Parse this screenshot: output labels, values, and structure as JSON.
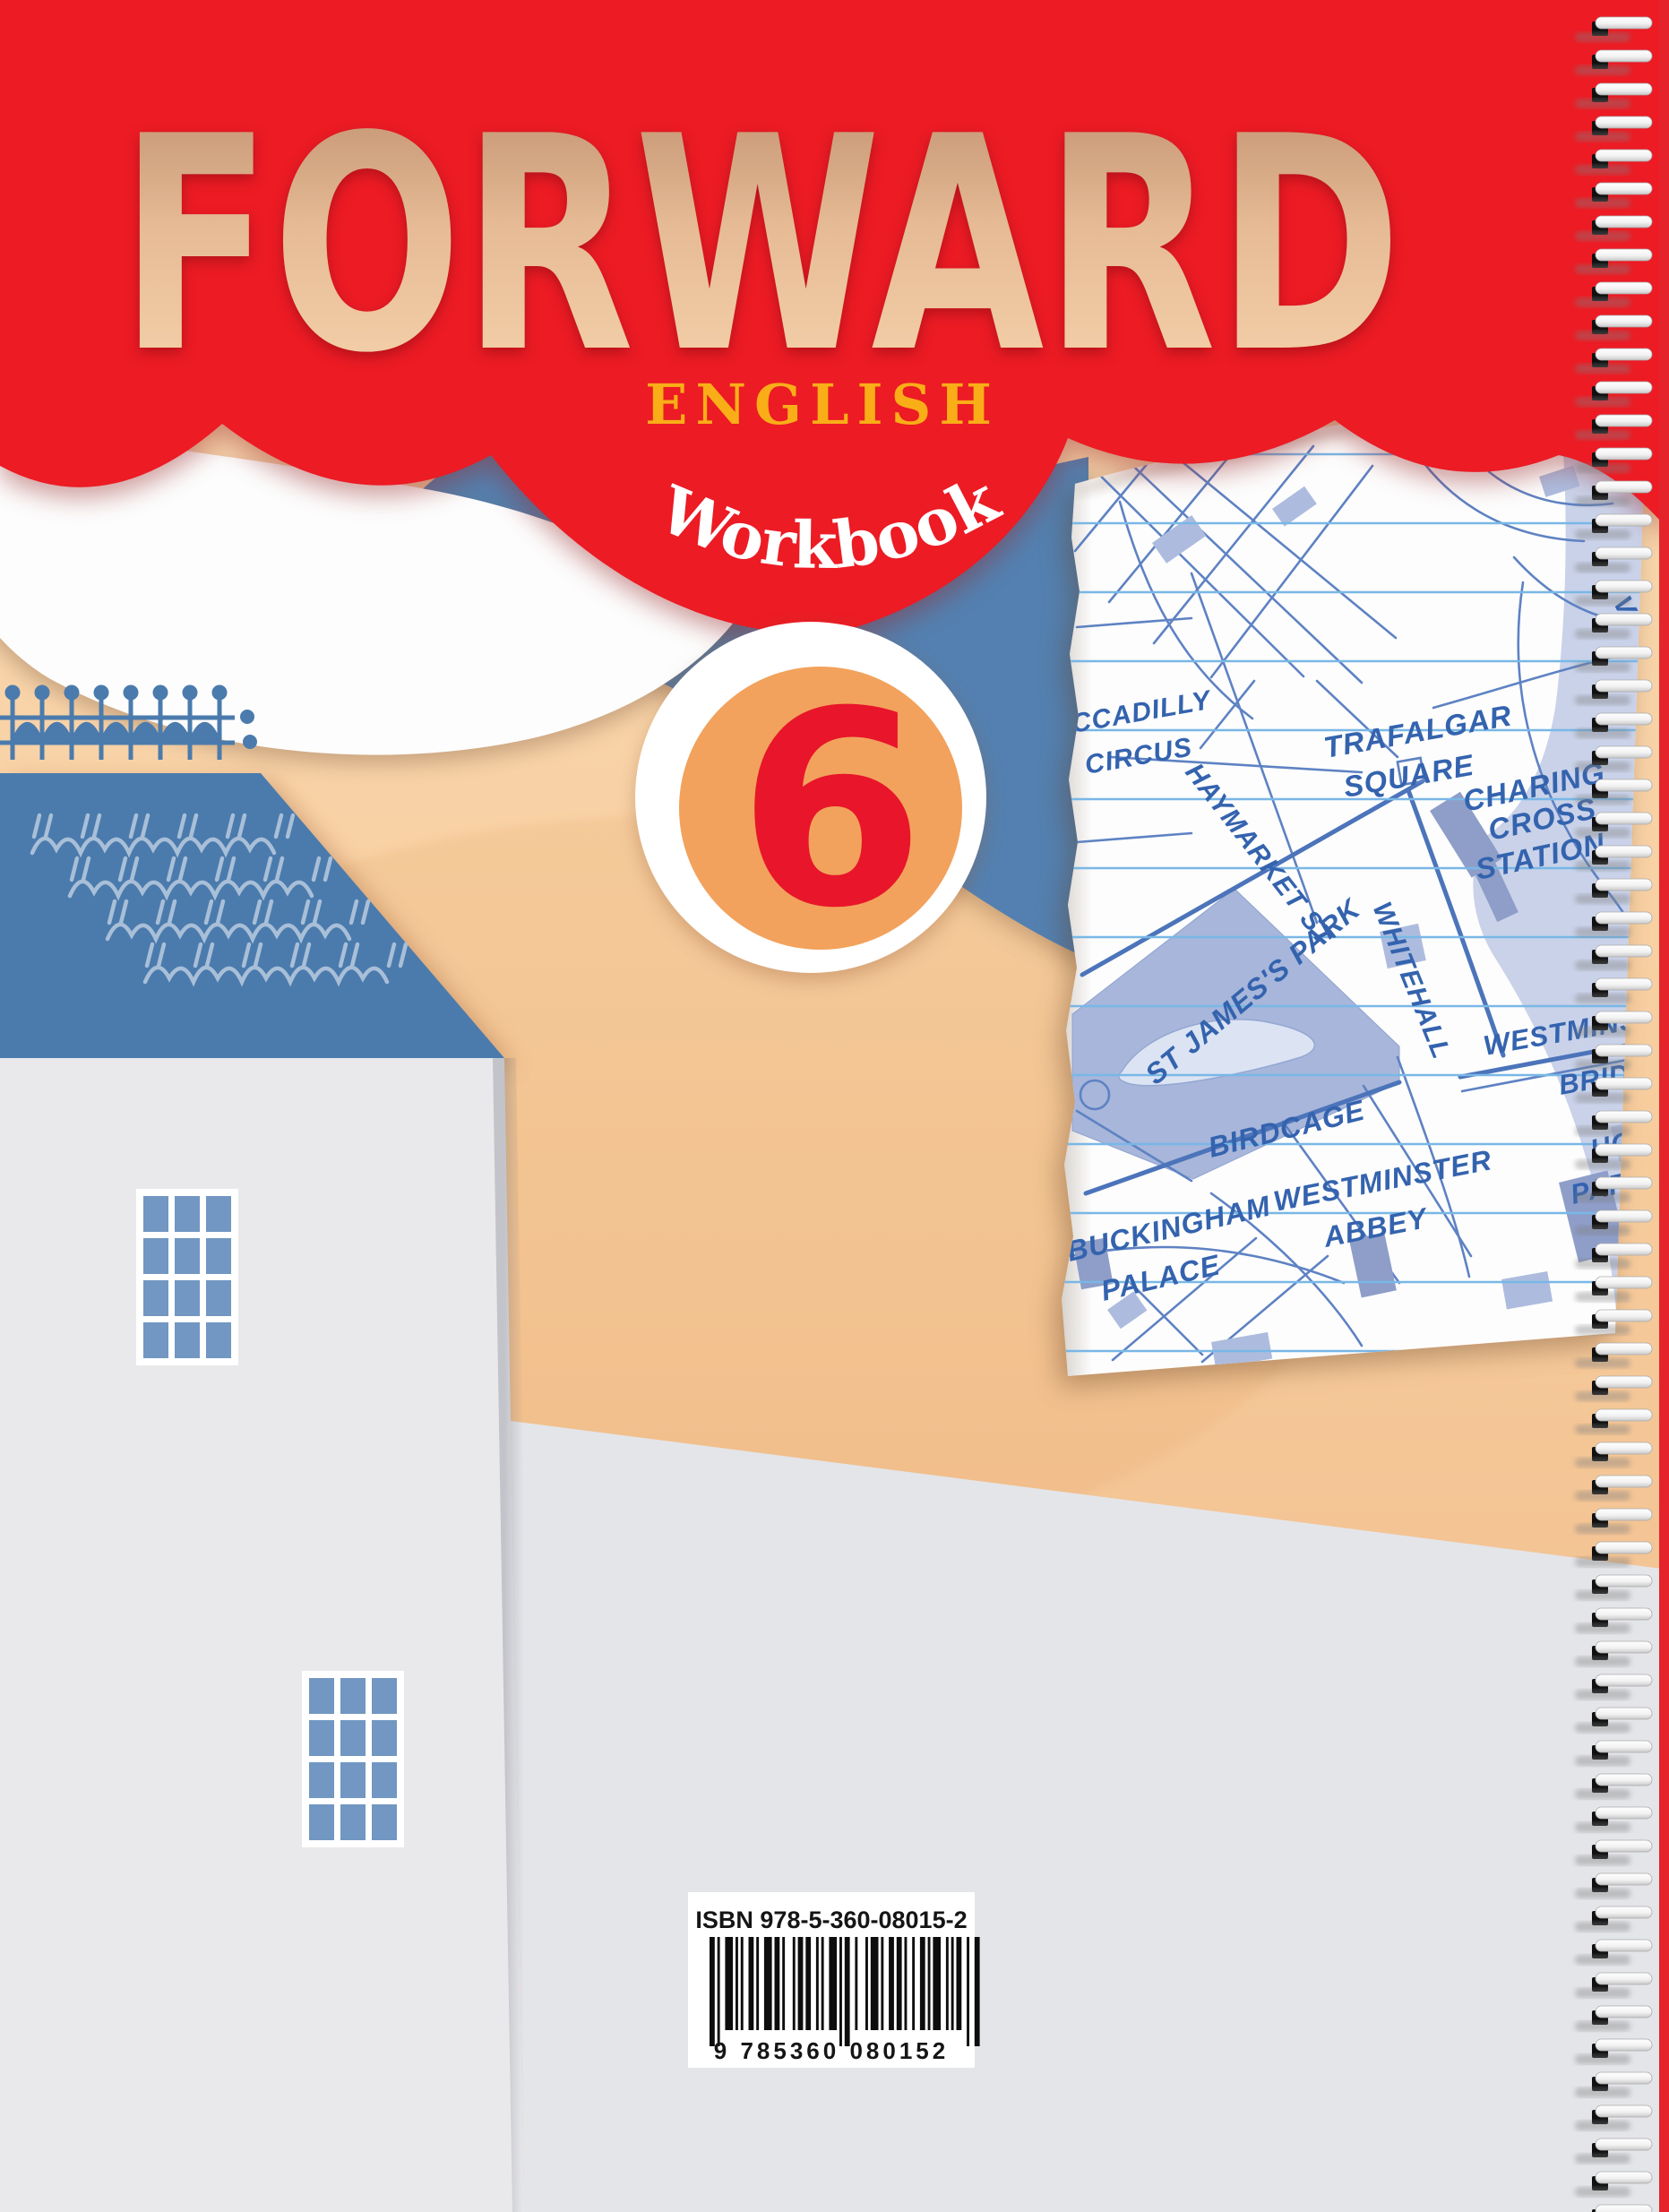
{
  "cover": {
    "title": "FORWARD",
    "subject": "ENGLISH",
    "book_type": "Workbook",
    "level": "6"
  },
  "map_labels": [
    "CCADILLY",
    "CIRCUS",
    "TRAFALGAR",
    "SQUARE",
    "CHARING",
    "CROSS",
    "STATION",
    "HAYMARKET ST",
    "WHITEHALL",
    "ST JAMES'S PARK",
    "BIRDCAGE",
    "WESTMINSTER",
    "ABBEY",
    "BUCKINGHAM",
    "PALACE",
    "WESTMINSTER",
    "BRIDGE",
    "HOUSES",
    "PARLIAM",
    "VI"
  ],
  "barcode": {
    "isbn": "ISBN 978-5-360-08015-2",
    "digits": "9 785360 080152"
  },
  "colors": {
    "red": "#EC1B24",
    "peach": "#F8D2A6",
    "steel_blue": "#4B7BAD",
    "gold": "#F9AE17",
    "badge_orange": "#F2A25C",
    "map_blue": "#5E82C3",
    "paper": "#FDFDFD",
    "wall_gray": "#E6E7EA"
  }
}
